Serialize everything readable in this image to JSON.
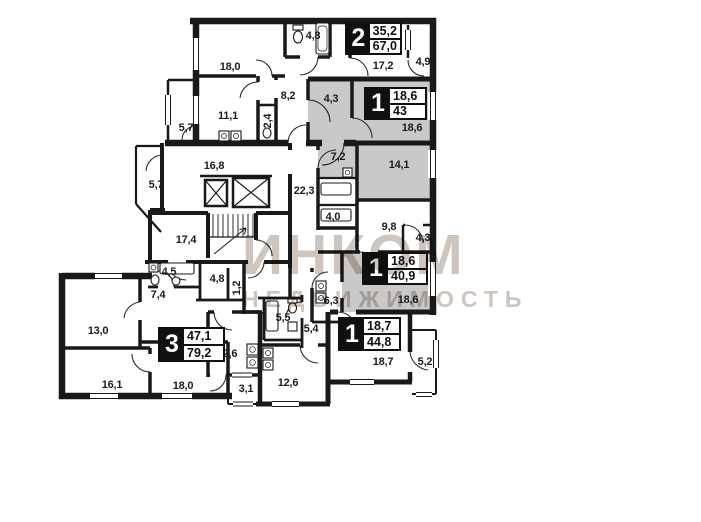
{
  "watermark": {
    "title": "ИНКОМ",
    "subtitle": "НЕДВИЖИМОСТЬ"
  },
  "colors": {
    "wall": "#191919",
    "highlight": "#c9c9c9",
    "watermark": "#cec5bf"
  },
  "apartments": [
    {
      "rooms_count": "2",
      "living_area": "35,2",
      "total_area": "67,0",
      "highlighted": false
    },
    {
      "rooms_count": "1",
      "living_area": "18,6",
      "total_area": "43",
      "highlighted": true
    },
    {
      "rooms_count": "1",
      "living_area": "18,6",
      "total_area": "40,9",
      "highlighted": true
    },
    {
      "rooms_count": "1",
      "living_area": "18,7",
      "total_area": "44,8",
      "highlighted": false
    },
    {
      "rooms_count": "3",
      "living_area": "47,1",
      "total_area": "79,2",
      "highlighted": false
    }
  ],
  "rooms": [
    "18,0",
    "4,8",
    "17,2",
    "4,9",
    "8,2",
    "11,1",
    "2,4",
    "5,7",
    "4,3",
    "18,6",
    "16,8",
    "5,7",
    "22,3",
    "7,2",
    "14,1",
    "4,0",
    "9,8",
    "4,3",
    "17,4",
    "4,5",
    "7,4",
    "4,8",
    "1,2",
    "6,3",
    "18,6",
    "13,0",
    "5,5",
    "5,4",
    "12,6",
    "16,1",
    "18,0",
    "3,1",
    "12,6",
    "18,7",
    "5,2"
  ]
}
